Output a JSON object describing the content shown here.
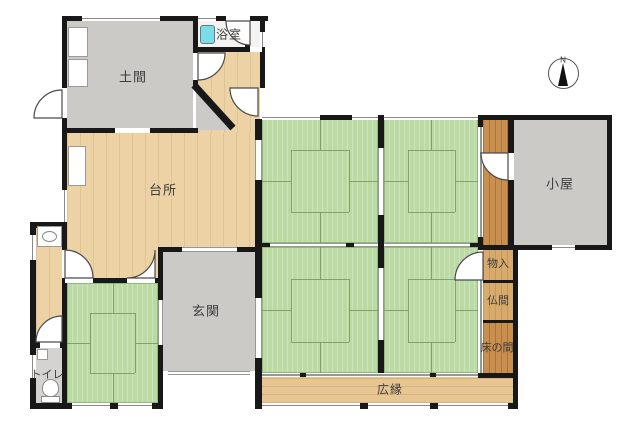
{
  "plan_title": "Japanese house floor plan",
  "rooms": {
    "doma": {
      "label": "土間"
    },
    "bathroom": {
      "label": "浴室"
    },
    "kitchen": {
      "label": "台所"
    },
    "genkan": {
      "label": "玄関"
    },
    "toilet": {
      "label": "トイレ"
    },
    "shed": {
      "label": "小屋"
    },
    "closet": {
      "label": "物入"
    },
    "butsuma": {
      "label": "仏間"
    },
    "tokonoma": {
      "label": "床の間"
    },
    "veranda": {
      "label": "広縁"
    }
  },
  "compass": {
    "label": "N"
  },
  "colors": {
    "wall": "#181818",
    "tatami": "#bcdaa4",
    "tatamiLine": "#8fb97e",
    "woodLight": "#ecd2a5",
    "woodVeranda": "#e7c694",
    "woodDark": "#c88f4e",
    "woodCloset": "#d8aa6b",
    "gray": "#cbcac6",
    "grayToilet": "#d4d3d1",
    "bathFloor": "#f4f3f1",
    "tub": "#7adde9"
  }
}
